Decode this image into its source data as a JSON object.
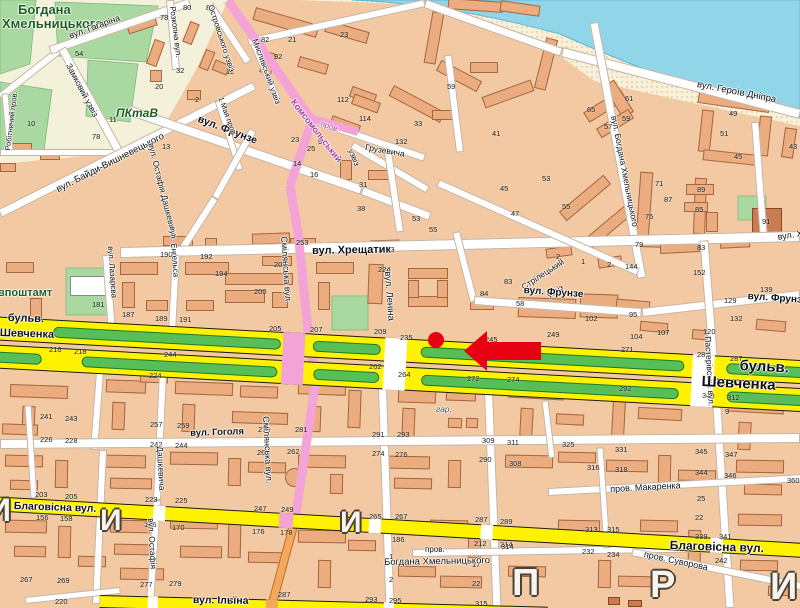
{
  "map": {
    "colors": {
      "land": "#F2C9A2",
      "building": "#EBAC80",
      "park": "#A9D9A1",
      "water": "#90D6E8",
      "beach": "#F8F0D9",
      "cream_zone": "#F4F1DA",
      "major_road": "#FFF200",
      "pink_road": "#F4A3D6",
      "orange_road": "#F4A75E",
      "median_green": "#58BE58",
      "marker_red": "#E60012",
      "park_label_green": "#1C5E20",
      "komsomol_purple": "#A03CA0"
    },
    "street_labels": [
      {
        "t": "Богдана",
        "x": 18,
        "y": 3,
        "r": 0,
        "s": 13,
        "w": "bold",
        "c": "#1C5E20"
      },
      {
        "t": "Хмельницького",
        "x": 2,
        "y": 17,
        "r": 0,
        "s": 13,
        "w": "bold",
        "c": "#1C5E20"
      },
      {
        "t": "ПКтаВ",
        "x": 116,
        "y": 107,
        "r": 0,
        "s": 12,
        "w": "bold",
        "c": "#1C5E20",
        "i": 1
      },
      {
        "t": "впоштамт",
        "x": -2,
        "y": 288,
        "r": 0,
        "s": 11,
        "w": "bold",
        "c": "#1C5E20"
      },
      {
        "t": "вул. Гагаріна",
        "x": 68,
        "y": 32,
        "r": -20,
        "s": 9
      },
      {
        "t": "Розкопна вул.",
        "x": 176,
        "y": 6,
        "r": 83,
        "s": 8
      },
      {
        "t": "Замковий узвіз",
        "x": 72,
        "y": 62,
        "r": 62,
        "s": 8.5
      },
      {
        "t": "Робітничий пров.",
        "x": 4,
        "y": 150,
        "r": -83,
        "s": 7.5
      },
      {
        "t": "Островського узвіз",
        "x": 214,
        "y": 4,
        "r": 72,
        "s": 8
      },
      {
        "t": "Мисливський узвіз",
        "x": 258,
        "y": 38,
        "r": 70,
        "s": 8
      },
      {
        "t": "вул. Байди-Вишневецького",
        "x": 55,
        "y": 186,
        "r": -27,
        "s": 9.5
      },
      {
        "t": "вул. Остафія Дашкевича",
        "x": 155,
        "y": 142,
        "r": 76,
        "s": 8.5
      },
      {
        "t": "вул. Фрунзе",
        "x": 200,
        "y": 114,
        "r": 21,
        "s": 10.5,
        "w": "bold"
      },
      {
        "t": "1 Мая пров.",
        "x": 224,
        "y": 96,
        "r": 70,
        "s": 7.5
      },
      {
        "t": "Комсомольський",
        "x": 296,
        "y": 98,
        "r": 52,
        "s": 9,
        "c": "#A03CA0",
        "w": "bold"
      },
      {
        "t": "пров.",
        "x": 322,
        "y": 120,
        "r": 20,
        "s": 8,
        "c": "#A03CA0"
      },
      {
        "t": "узвіз",
        "x": 354,
        "y": 148,
        "r": 68,
        "s": 8
      },
      {
        "t": "Грузевича",
        "x": 366,
        "y": 143,
        "r": 10,
        "s": 8.5
      },
      {
        "t": "вул. Хрещатик",
        "x": 312,
        "y": 246,
        "r": -1,
        "s": 11,
        "w": "bold"
      },
      {
        "t": "вул. Хрещатик",
        "x": 777,
        "y": 233,
        "r": -9,
        "s": 9
      },
      {
        "t": "Смілянська вул.",
        "x": 288,
        "y": 236,
        "r": 86,
        "s": 9
      },
      {
        "t": "Смілянська вул.",
        "x": 270,
        "y": 416,
        "r": 87,
        "s": 9
      },
      {
        "t": "вул. Леніна",
        "x": 392,
        "y": 271,
        "r": 86,
        "s": 9.5
      },
      {
        "t": "Стрілецький",
        "x": 520,
        "y": 284,
        "r": -33,
        "s": 8.5
      },
      {
        "t": "узвіз",
        "x": 546,
        "y": 293,
        "r": -33,
        "s": 8
      },
      {
        "t": "вул. Фрунзе",
        "x": 524,
        "y": 286,
        "r": 4,
        "s": 10,
        "w": "bold"
      },
      {
        "t": "вул. Фрунзе",
        "x": 748,
        "y": 292,
        "r": 4,
        "s": 10,
        "w": "bold"
      },
      {
        "t": "вул. Богдана Хмельницького",
        "x": 618,
        "y": 115,
        "r": 79,
        "s": 8.5
      },
      {
        "t": "вул. Героїв Дніпра",
        "x": 698,
        "y": 80,
        "r": 11,
        "s": 9.5
      },
      {
        "t": "Пастерівська вул.",
        "x": 712,
        "y": 336,
        "r": 87,
        "s": 8.5
      },
      {
        "t": "бульв.",
        "x": 8,
        "y": 313,
        "r": 2,
        "s": 11,
        "w": "bold"
      },
      {
        "t": "Шевченка",
        "x": 0,
        "y": 328,
        "r": 2,
        "s": 11,
        "w": "bold"
      },
      {
        "t": "бульв.",
        "x": 740,
        "y": 358,
        "r": 3,
        "s": 15,
        "w": "bold"
      },
      {
        "t": "Шевченка",
        "x": 702,
        "y": 374,
        "r": 3,
        "s": 15,
        "w": "bold"
      },
      {
        "t": "вул. Гоголя",
        "x": 190,
        "y": 429,
        "r": -2,
        "s": 9.5,
        "w": "bold"
      },
      {
        "t": "Благовісна вул.",
        "x": 14,
        "y": 501,
        "r": 2,
        "s": 10.5,
        "w": "bold"
      },
      {
        "t": "Благовісна вул.",
        "x": 670,
        "y": 539,
        "r": 2,
        "s": 12,
        "w": "bold"
      },
      {
        "t": "пров. Макаренка",
        "x": 610,
        "y": 485,
        "r": -3,
        "s": 9
      },
      {
        "t": "пров.",
        "x": 425,
        "y": 546,
        "r": 0,
        "s": 8
      },
      {
        "t": "Богдана Хмельницького",
        "x": 384,
        "y": 558,
        "r": -1,
        "s": 9.5
      },
      {
        "t": "вул. Ільїна",
        "x": 193,
        "y": 595,
        "r": 1,
        "s": 10.5,
        "w": "bold"
      },
      {
        "t": "пров. Суворова",
        "x": 645,
        "y": 550,
        "r": 12,
        "s": 9
      },
      {
        "t": "вул. Остафія",
        "x": 155,
        "y": 518,
        "r": 87,
        "s": 8.5
      },
      {
        "t": "Дашкевича",
        "x": 164,
        "y": 446,
        "r": 87,
        "s": 8.5
      },
      {
        "t": "вул. Лазарєва",
        "x": 114,
        "y": 246,
        "r": 86,
        "s": 8
      },
      {
        "t": "вул. Енгельса",
        "x": 176,
        "y": 226,
        "r": 86,
        "s": 8
      },
      {
        "t": "гар.",
        "x": 436,
        "y": 405,
        "r": 0,
        "s": 8.5,
        "i": 1,
        "c": "#4a4a4a"
      }
    ],
    "house_numbers": [
      [
        "80",
        183,
        4
      ],
      [
        "78",
        160,
        14
      ],
      [
        "54",
        75,
        50
      ],
      [
        "32",
        176,
        67
      ],
      [
        "20",
        155,
        83
      ],
      [
        "2",
        195,
        96
      ],
      [
        "11",
        109,
        116
      ],
      [
        "78",
        92,
        133
      ],
      [
        "13",
        162,
        143
      ],
      [
        "10",
        27,
        120
      ],
      [
        "82",
        206,
        4
      ],
      [
        "82",
        261,
        36
      ],
      [
        "92",
        274,
        53
      ],
      [
        "12",
        226,
        68
      ],
      [
        "21",
        288,
        36
      ],
      [
        "23",
        340,
        31
      ],
      [
        "112",
        337,
        96
      ],
      [
        "114",
        359,
        115
      ],
      [
        "23",
        291,
        136
      ],
      [
        "25",
        307,
        145
      ],
      [
        "9",
        318,
        138
      ],
      [
        "14",
        293,
        160
      ],
      [
        "16",
        310,
        171
      ],
      [
        "253",
        296,
        239
      ],
      [
        "132",
        395,
        138
      ],
      [
        "33",
        414,
        120
      ],
      [
        "59",
        447,
        83
      ],
      [
        "41",
        492,
        130
      ],
      [
        "45",
        500,
        185
      ],
      [
        "47",
        511,
        210
      ],
      [
        "31",
        359,
        181
      ],
      [
        "38",
        357,
        205
      ],
      [
        "53",
        412,
        215
      ],
      [
        "55",
        429,
        226
      ],
      [
        "53",
        542,
        175
      ],
      [
        "61",
        625,
        95
      ],
      [
        "65",
        587,
        106
      ],
      [
        "59",
        622,
        115
      ],
      [
        "57",
        604,
        123
      ],
      [
        "49",
        729,
        110
      ],
      [
        "51",
        720,
        130
      ],
      [
        "45",
        734,
        153
      ],
      [
        "43",
        789,
        143
      ],
      [
        "71",
        655,
        180
      ],
      [
        "87",
        664,
        196
      ],
      [
        "89",
        697,
        186
      ],
      [
        "85",
        695,
        206
      ],
      [
        "75",
        645,
        213
      ],
      [
        "91",
        762,
        218
      ],
      [
        "79",
        635,
        241
      ],
      [
        "83",
        697,
        244
      ],
      [
        "55",
        562,
        203
      ],
      [
        "2",
        607,
        261
      ],
      [
        "1",
        581,
        258
      ],
      [
        "2",
        556,
        253
      ],
      [
        "144",
        625,
        263
      ],
      [
        "152",
        693,
        269
      ],
      [
        "139",
        760,
        286
      ],
      [
        "129",
        724,
        297
      ],
      [
        "132",
        730,
        315
      ],
      [
        "120",
        703,
        328
      ],
      [
        "95",
        629,
        311
      ],
      [
        "107",
        657,
        329
      ],
      [
        "104",
        630,
        333
      ],
      [
        "102",
        585,
        315
      ],
      [
        "190",
        160,
        251
      ],
      [
        "192",
        200,
        253
      ],
      [
        "194",
        215,
        270
      ],
      [
        "200",
        254,
        288
      ],
      [
        "208",
        274,
        261
      ],
      [
        "263",
        382,
        246
      ],
      [
        "224",
        378,
        266
      ],
      [
        "84",
        480,
        290
      ],
      [
        "58",
        516,
        300
      ],
      [
        "83",
        504,
        278
      ],
      [
        "181",
        92,
        301
      ],
      [
        "187",
        122,
        311
      ],
      [
        "189",
        155,
        315
      ],
      [
        "191",
        179,
        316
      ],
      [
        "205",
        269,
        325
      ],
      [
        "207",
        310,
        326
      ],
      [
        "209",
        374,
        328
      ],
      [
        "235",
        400,
        334
      ],
      [
        "245",
        485,
        336
      ],
      [
        "249",
        547,
        331
      ],
      [
        "271",
        621,
        346
      ],
      [
        "285",
        697,
        351
      ],
      [
        "287",
        730,
        355
      ],
      [
        "216",
        49,
        346
      ],
      [
        "218",
        74,
        348
      ],
      [
        "244",
        164,
        351
      ],
      [
        "262",
        369,
        363
      ],
      [
        "264",
        398,
        371
      ],
      [
        "272",
        467,
        375
      ],
      [
        "274",
        507,
        376
      ],
      [
        "292",
        619,
        385
      ],
      [
        "310",
        702,
        392
      ],
      [
        "312",
        727,
        394
      ],
      [
        "224",
        149,
        372
      ],
      [
        "9",
        725,
        408
      ],
      [
        "241",
        40,
        413
      ],
      [
        "243",
        65,
        415
      ],
      [
        "257",
        150,
        421
      ],
      [
        "259",
        177,
        422
      ],
      [
        "226",
        40,
        436
      ],
      [
        "228",
        65,
        437
      ],
      [
        "242",
        150,
        441
      ],
      [
        "244",
        175,
        442
      ],
      [
        "203",
        35,
        491
      ],
      [
        "205",
        65,
        493
      ],
      [
        "223",
        145,
        496
      ],
      [
        "225",
        175,
        497
      ],
      [
        "156",
        36,
        514
      ],
      [
        "158",
        60,
        515
      ],
      [
        "186",
        144,
        521
      ],
      [
        "170",
        172,
        524
      ],
      [
        "176",
        252,
        528
      ],
      [
        "178",
        280,
        529
      ],
      [
        "267",
        20,
        576
      ],
      [
        "269",
        57,
        577
      ],
      [
        "277",
        140,
        581
      ],
      [
        "279",
        169,
        580
      ],
      [
        "220",
        55,
        598
      ],
      [
        "279",
        258,
        426
      ],
      [
        "281",
        295,
        426
      ],
      [
        "260",
        257,
        449
      ],
      [
        "262",
        287,
        448
      ],
      [
        "247",
        254,
        505
      ],
      [
        "249",
        281,
        506
      ],
      [
        "287",
        278,
        591
      ],
      [
        "293",
        365,
        596
      ],
      [
        "295",
        389,
        597
      ],
      [
        "291",
        372,
        431
      ],
      [
        "293",
        397,
        431
      ],
      [
        "274",
        372,
        450
      ],
      [
        "276",
        395,
        451
      ],
      [
        "265",
        369,
        513
      ],
      [
        "267",
        395,
        513
      ],
      [
        "186",
        392,
        536
      ],
      [
        "1",
        389,
        553
      ],
      [
        "2",
        389,
        576
      ],
      [
        "309",
        482,
        437
      ],
      [
        "311",
        507,
        439
      ],
      [
        "290",
        479,
        456
      ],
      [
        "308",
        509,
        460
      ],
      [
        "287",
        475,
        516
      ],
      [
        "289",
        500,
        518
      ],
      [
        "212",
        474,
        540
      ],
      [
        "214",
        500,
        541
      ],
      [
        "17",
        472,
        561
      ],
      [
        "22",
        472,
        580
      ],
      [
        "315",
        475,
        600
      ],
      [
        "325",
        562,
        441
      ],
      [
        "331",
        615,
        446
      ],
      [
        "345",
        695,
        448
      ],
      [
        "347",
        725,
        451
      ],
      [
        "316",
        587,
        464
      ],
      [
        "318",
        615,
        466
      ],
      [
        "344",
        695,
        469
      ],
      [
        "346",
        724,
        472
      ],
      [
        "360",
        787,
        477
      ],
      [
        "25",
        697,
        495
      ],
      [
        "22",
        695,
        514
      ],
      [
        "313",
        585,
        526
      ],
      [
        "315",
        607,
        526
      ],
      [
        "339",
        695,
        533
      ],
      [
        "341",
        719,
        533
      ],
      [
        "314",
        501,
        543
      ],
      [
        "232",
        582,
        548
      ],
      [
        "234",
        607,
        551
      ],
      [
        "242",
        715,
        557
      ]
    ],
    "watermark_letters": [
      {
        "t": "И",
        "x": -12,
        "y": 494,
        "s": 32
      },
      {
        "t": "И",
        "x": 100,
        "y": 506,
        "s": 30
      },
      {
        "t": "И",
        "x": 340,
        "y": 508,
        "s": 30
      },
      {
        "t": "П",
        "x": 512,
        "y": 564,
        "s": 38
      },
      {
        "t": "Р",
        "x": 650,
        "y": 566,
        "s": 38
      },
      {
        "t": "И",
        "x": 770,
        "y": 568,
        "s": 38
      }
    ],
    "marker": {
      "dot": {
        "x": 436,
        "y": 340,
        "r": 8,
        "color": "#E60012"
      },
      "arrow": {
        "tip_x": 464,
        "tip_y": 351,
        "tail_x": 541,
        "tail_y": 351,
        "color": "#E60012"
      }
    }
  }
}
